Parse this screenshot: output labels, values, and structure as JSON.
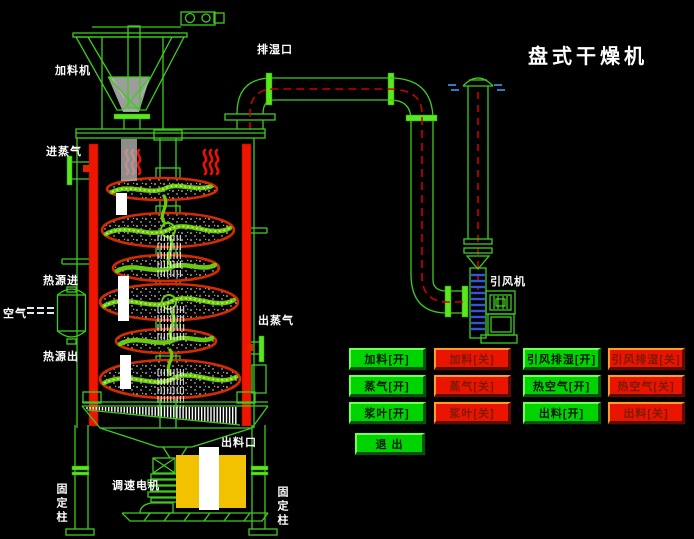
{
  "title": "盘式干燥机",
  "diagram": {
    "labels": {
      "feeder": "加料机",
      "exhaust_port": "排湿口",
      "steam_in": "进蒸气",
      "heat_in": "热源进",
      "air": "空气",
      "heat_out": "热源出",
      "steam_out": "出蒸气",
      "fan": "引风机",
      "discharge_port": "出料口",
      "speed_motor": "调速电机",
      "fixed_column_left": "固定柱",
      "fixed_column_right": "固定柱"
    },
    "colors": {
      "line_green": "#3fcc1f",
      "hot_column_red": "#ef1500",
      "disc_rim": "#d42b00",
      "paddle_green": "#6cc812",
      "motor_yellow": "#f2c200",
      "pipe_centerline_red": "#cc0000",
      "air_flow_blue": "#2e7bc4",
      "button_on_green": "#00d400",
      "button_off_red": "#ea1500",
      "label_white": "#ffffff"
    }
  },
  "controls": {
    "buttons": [
      {
        "label": "加料[开]",
        "state": "on"
      },
      {
        "label": "加料[关]",
        "state": "off"
      },
      {
        "label": "引风排湿[开]",
        "state": "on"
      },
      {
        "label": "引风排湿[关]",
        "state": "off"
      },
      {
        "label": "蒸气[开]",
        "state": "on"
      },
      {
        "label": "蒸气[关]",
        "state": "off"
      },
      {
        "label": "热空气[开]",
        "state": "on"
      },
      {
        "label": "热空气[关]",
        "state": "off"
      },
      {
        "label": "浆叶[开]",
        "state": "on"
      },
      {
        "label": "浆叶[关]",
        "state": "off"
      },
      {
        "label": "出料[开]",
        "state": "on"
      },
      {
        "label": "出料[关]",
        "state": "off"
      }
    ],
    "exit_label": "退 出"
  }
}
